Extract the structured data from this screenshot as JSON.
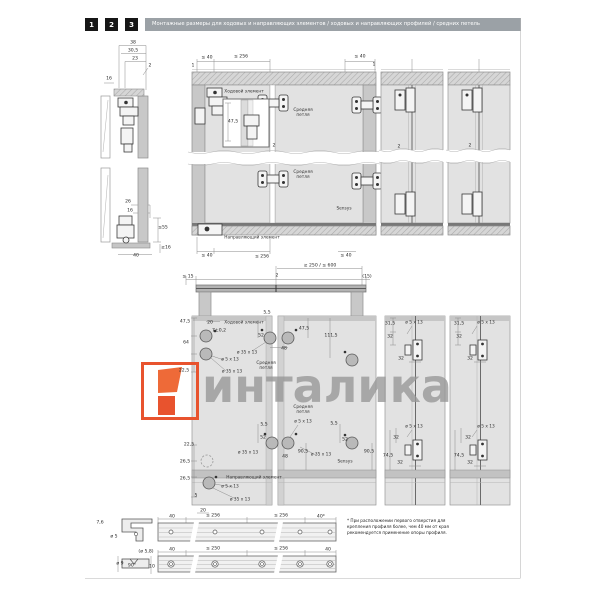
{
  "page": {
    "header": {
      "steps": [
        "1",
        "2",
        "3"
      ],
      "title": "Монтажные размеры для ходовых и направляющих элементов / ходовых и направляющих профилей / средних петель"
    },
    "watermark": {
      "text": "инталика",
      "logo_color": "#e8532e",
      "text_color": "#969696"
    },
    "note": "* При расположении первого отверстия для крепления профиля более, чем 40 мм от края рекомендуется применение опоры профиля.",
    "colors": {
      "header_bar": "#9ba1a6",
      "step_box": "#161616",
      "accent_orange": "#e8532e"
    }
  },
  "drawing_labels": [
    {
      "t": "38",
      "x": 133,
      "y": 43
    },
    {
      "t": "30,5",
      "x": 133,
      "y": 51
    },
    {
      "t": "23",
      "x": 135,
      "y": 59
    },
    {
      "t": "2",
      "x": 150,
      "y": 66
    },
    {
      "t": "16",
      "x": 109,
      "y": 79
    },
    {
      "t": "26",
      "x": 128,
      "y": 202
    },
    {
      "t": "16",
      "x": 130,
      "y": 211
    },
    {
      "t": "≤55",
      "x": 163,
      "y": 228
    },
    {
      "t": "≥16",
      "x": 166,
      "y": 248
    },
    {
      "t": "40",
      "x": 136,
      "y": 256
    },
    {
      "t": "≤ 40",
      "x": 207,
      "y": 58
    },
    {
      "t": "≤ 256",
      "x": 241,
      "y": 57
    },
    {
      "t": "≤ 40",
      "x": 360,
      "y": 57
    },
    {
      "t": "1",
      "x": 193,
      "y": 66
    },
    {
      "t": "1",
      "x": 374,
      "y": 65
    },
    {
      "t": "Ходовой элемент",
      "x": 244,
      "y": 92,
      "cls": "lbl",
      "n": "label-running-element"
    },
    {
      "t": "47,5",
      "x": 233,
      "y": 122
    },
    {
      "t": "Средняя\nпетля",
      "x": 303,
      "y": 113,
      "cls": "lbl pre",
      "n": "label-middle-hinge"
    },
    {
      "t": "Средняя\nпетля",
      "x": 303,
      "y": 175,
      "cls": "lbl pre",
      "n": "label-middle-hinge"
    },
    {
      "t": "Sensys",
      "x": 344,
      "y": 209,
      "cls": "lbl",
      "n": "label-sensys"
    },
    {
      "t": "2",
      "x": 274,
      "y": 146
    },
    {
      "t": "2",
      "x": 399,
      "y": 147
    },
    {
      "t": "2",
      "x": 470,
      "y": 146
    },
    {
      "t": "Направляющий элемент",
      "x": 252,
      "y": 238,
      "cls": "lbl",
      "n": "label-guide-element"
    },
    {
      "t": "≤ 40",
      "x": 207,
      "y": 256
    },
    {
      "t": "≤ 256",
      "x": 262,
      "y": 257
    },
    {
      "t": "≤ 40",
      "x": 346,
      "y": 256
    },
    {
      "t": "≥ 250 / ≤ 600",
      "x": 320,
      "y": 266
    },
    {
      "t": "≤ 15",
      "x": 188,
      "y": 277
    },
    {
      "t": "2",
      "x": 277,
      "y": 276
    },
    {
      "t": "(15)",
      "x": 367,
      "y": 277
    },
    {
      "t": "47,5",
      "x": 185,
      "y": 322
    },
    {
      "t": "20",
      "x": 210,
      "y": 323
    },
    {
      "t": "Ходовой элемент",
      "x": 244,
      "y": 323,
      "cls": "lbl",
      "n": "label-running-element"
    },
    {
      "t": "7±0,2",
      "x": 219,
      "y": 331
    },
    {
      "t": "64",
      "x": 186,
      "y": 343
    },
    {
      "t": "ø 5 x 13",
      "x": 230,
      "y": 360,
      "cls": "lbl"
    },
    {
      "t": "ø 35 x 13",
      "x": 232,
      "y": 372,
      "cls": "lbl"
    },
    {
      "t": "22,5",
      "x": 184,
      "y": 371
    },
    {
      "t": "5,5",
      "x": 267,
      "y": 313
    },
    {
      "t": "52",
      "x": 261,
      "y": 336
    },
    {
      "t": "ø 35 x 13",
      "x": 247,
      "y": 353,
      "cls": "lbl"
    },
    {
      "t": "Средняя\nпетля",
      "x": 266,
      "y": 366,
      "cls": "lbl pre",
      "n": "label-middle-hinge"
    },
    {
      "t": "48",
      "x": 284,
      "y": 349
    },
    {
      "t": "47,5",
      "x": 304,
      "y": 329
    },
    {
      "t": "111,5",
      "x": 331,
      "y": 336
    },
    {
      "t": "Средняя\nпетля",
      "x": 303,
      "y": 410,
      "cls": "lbl pre",
      "n": "label-middle-hinge"
    },
    {
      "t": "ø 5 x 13",
      "x": 303,
      "y": 422,
      "cls": "lbl"
    },
    {
      "t": "5,5",
      "x": 264,
      "y": 425
    },
    {
      "t": "52",
      "x": 263,
      "y": 438
    },
    {
      "t": "ø 35 x 13",
      "x": 248,
      "y": 453,
      "cls": "lbl"
    },
    {
      "t": "48",
      "x": 285,
      "y": 457
    },
    {
      "t": "90,5",
      "x": 303,
      "y": 452
    },
    {
      "t": "5,5",
      "x": 334,
      "y": 424
    },
    {
      "t": "52",
      "x": 345,
      "y": 440
    },
    {
      "t": "ø 35 x 13",
      "x": 321,
      "y": 455,
      "cls": "lbl"
    },
    {
      "t": "Sensys",
      "x": 345,
      "y": 462,
      "cls": "lbl",
      "n": "label-sensys"
    },
    {
      "t": "90,5",
      "x": 369,
      "y": 452
    },
    {
      "t": "22,5",
      "x": 189,
      "y": 445
    },
    {
      "t": "26,5",
      "x": 185,
      "y": 462
    },
    {
      "t": "26,5",
      "x": 185,
      "y": 479
    },
    {
      "t": "Направляющий элемент",
      "x": 254,
      "y": 478,
      "cls": "lbl",
      "n": "label-guide-element"
    },
    {
      "t": "ø 5 x 13",
      "x": 230,
      "y": 487,
      "cls": "lbl"
    },
    {
      "t": "ø 35 x 13",
      "x": 240,
      "y": 500,
      "cls": "lbl"
    },
    {
      "t": "5",
      "x": 196,
      "y": 496
    },
    {
      "t": "31,5",
      "x": 390,
      "y": 324
    },
    {
      "t": "ø 5 x 13",
      "x": 414,
      "y": 323,
      "cls": "lbl"
    },
    {
      "t": "32",
      "x": 390,
      "y": 337
    },
    {
      "t": "32",
      "x": 401,
      "y": 359
    },
    {
      "t": "31,5",
      "x": 459,
      "y": 324
    },
    {
      "t": "ø 5 x 13",
      "x": 486,
      "y": 323,
      "cls": "lbl"
    },
    {
      "t": "32",
      "x": 459,
      "y": 337
    },
    {
      "t": "32",
      "x": 470,
      "y": 359
    },
    {
      "t": "ø 5 x 13",
      "x": 414,
      "y": 427,
      "cls": "lbl"
    },
    {
      "t": "32",
      "x": 396,
      "y": 438
    },
    {
      "t": "74,5",
      "x": 388,
      "y": 456
    },
    {
      "t": "32",
      "x": 400,
      "y": 463
    },
    {
      "t": "ø 5 x 13",
      "x": 486,
      "y": 427,
      "cls": "lbl"
    },
    {
      "t": "32",
      "x": 468,
      "y": 438
    },
    {
      "t": "74,5",
      "x": 459,
      "y": 456
    },
    {
      "t": "32",
      "x": 470,
      "y": 463
    },
    {
      "t": "7,6",
      "x": 100,
      "y": 523
    },
    {
      "t": "ø 5",
      "x": 114,
      "y": 537
    },
    {
      "t": "20",
      "x": 203,
      "y": 511
    },
    {
      "t": "40",
      "x": 172,
      "y": 517
    },
    {
      "t": "≤ 256",
      "x": 213,
      "y": 516
    },
    {
      "t": "≤ 256",
      "x": 281,
      "y": 516
    },
    {
      "t": "40*",
      "x": 321,
      "y": 517
    },
    {
      "t": "(ø 5,8)",
      "x": 146,
      "y": 552
    },
    {
      "t": "ø 9",
      "x": 120,
      "y": 564
    },
    {
      "t": "90°",
      "x": 132,
      "y": 566
    },
    {
      "t": "10",
      "x": 152,
      "y": 567
    },
    {
      "t": "40",
      "x": 172,
      "y": 550
    },
    {
      "t": "≤ 250",
      "x": 213,
      "y": 549
    },
    {
      "t": "≤ 256",
      "x": 281,
      "y": 549
    },
    {
      "t": "40",
      "x": 328,
      "y": 550
    }
  ]
}
